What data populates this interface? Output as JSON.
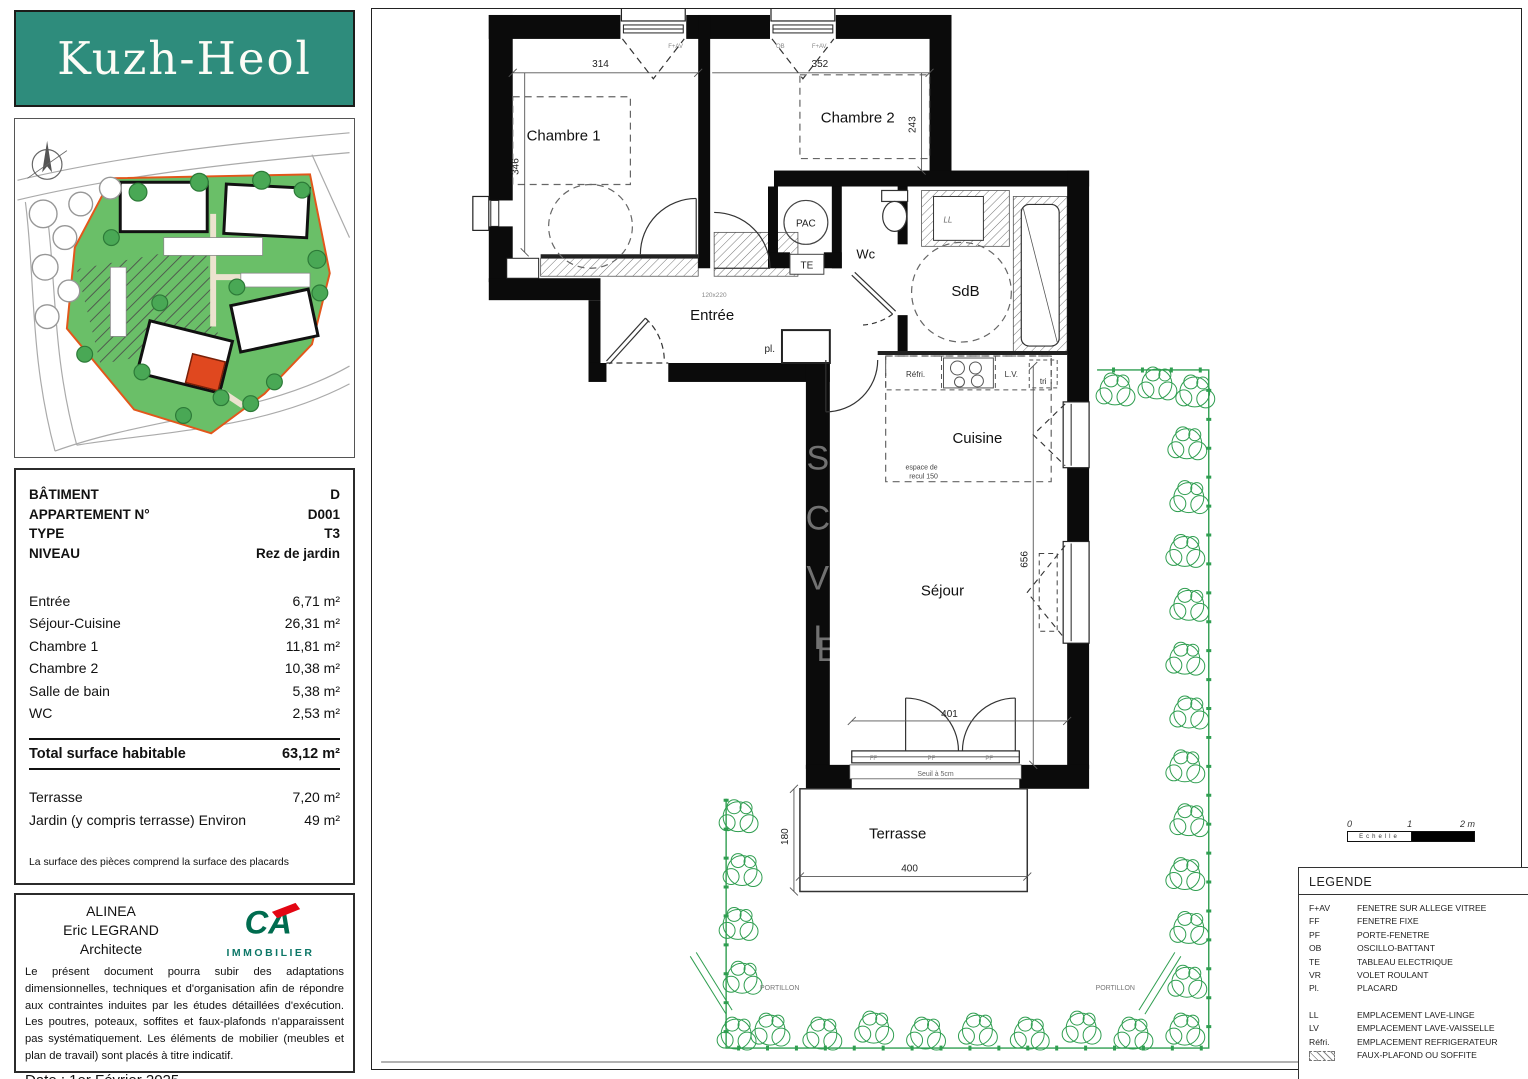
{
  "page": {
    "logo_text": "Kuzh-Heol"
  },
  "info": {
    "header_rows": [
      {
        "label": "BÂTIMENT",
        "value": "D"
      },
      {
        "label": "APPARTEMENT N°",
        "value": "D001"
      },
      {
        "label": "TYPE",
        "value": "T3"
      },
      {
        "label": "NIVEAU",
        "value": "Rez de jardin"
      }
    ],
    "area_rows": [
      {
        "label": "Entrée",
        "value": "6,71 m²"
      },
      {
        "label": "Séjour-Cuisine",
        "value": "26,31 m²"
      },
      {
        "label": "Chambre 1",
        "value": "11,81 m²"
      },
      {
        "label": "Chambre 2",
        "value": "10,38 m²"
      },
      {
        "label": "Salle de bain",
        "value": "5,38 m²"
      },
      {
        "label": "WC",
        "value": "2,53 m²"
      }
    ],
    "total_row": {
      "label": "Total surface habitable",
      "value": "63,12 m²"
    },
    "outdoor_rows": [
      {
        "label": "Terrasse",
        "value": "7,20 m²"
      },
      {
        "label": "Jardin (y compris terrasse) Environ",
        "value": "49 m²"
      }
    ],
    "note": "La surface des pièces comprend la surface des placards"
  },
  "architect": {
    "line1": "ALINEA",
    "line2": "Eric LEGRAND",
    "line3": "Architecte",
    "logo_text": "CA",
    "logo_sub": "IMMOBILIER",
    "disclaimer": "Le présent document pourra subir des adaptations dimensionnelles, techniques et d'organisation afin de répondre aux contraintes induites par les études détaillées d'exécution. Les poutres, poteaux, soffites et faux-plafonds n'apparaissent pas systématiquement. Les éléments de mobilier (meubles et plan de travail) sont placés à titre indicatif.",
    "date": "Date : 1er Février 2025"
  },
  "plan": {
    "rooms": {
      "chambre1": "Chambre 1",
      "chambre2": "Chambre 2",
      "entree": "Entrée",
      "wc": "Wc",
      "sdb": "SdB",
      "cuisine": "Cuisine",
      "sejour": "Séjour",
      "terrasse": "Terrasse"
    },
    "annotations": {
      "pac": "PAC",
      "te": "TE",
      "pl": "pl.",
      "refri": "Réfri.",
      "lv": "L.V.",
      "tri": "tri",
      "ll": "LL",
      "ob": "OB",
      "fav": "F+AV",
      "ff": "FF",
      "pf": "PF",
      "recul1": "espace de",
      "recul2": "recul 150",
      "seuil": "Seuil à 5cm",
      "door_size": "120x220",
      "portillon": "PORTILLON"
    },
    "dims": {
      "d314": "314",
      "d352": "352",
      "d346": "346",
      "d243": "243",
      "d656": "656",
      "d401": "401",
      "d400": "400",
      "d180": "180"
    }
  },
  "scalebar": {
    "t0": "0",
    "t1": "1",
    "t2": "2 m",
    "label": "Echelle"
  },
  "legend": {
    "title": "LEGENDE",
    "items": [
      {
        "abbr": "F+AV",
        "label": "FENETRE SUR ALLEGE VITREE"
      },
      {
        "abbr": "FF",
        "label": "FENETRE FIXE"
      },
      {
        "abbr": "PF",
        "label": "PORTE-FENETRE"
      },
      {
        "abbr": "OB",
        "label": "OSCILLO-BATTANT"
      },
      {
        "abbr": "TE",
        "label": "TABLEAU ELECTRIQUE"
      },
      {
        "abbr": "VR",
        "label": "VOLET ROULANT"
      },
      {
        "abbr": "Pl.",
        "label": "PLACARD"
      }
    ],
    "items2": [
      {
        "abbr": "LL",
        "label": "EMPLACEMENT LAVE-LINGE"
      },
      {
        "abbr": "LV",
        "label": "EMPLACEMENT LAVE-VAISSELLE"
      },
      {
        "abbr": "Réfri.",
        "label": "EMPLACEMENT REFRIGERATEUR"
      },
      {
        "abbr": "",
        "label": "FAUX-PLAFOND OU SOFFITE"
      }
    ]
  },
  "colors": {
    "teal": "#2e8c7c",
    "ca_green": "#006c4f",
    "ca_red": "#e30613",
    "site_green": "#6abf68",
    "hedge_green": "#2f9e50",
    "boundary_orange": "#e2571b",
    "unit_red": "#e0481f"
  }
}
